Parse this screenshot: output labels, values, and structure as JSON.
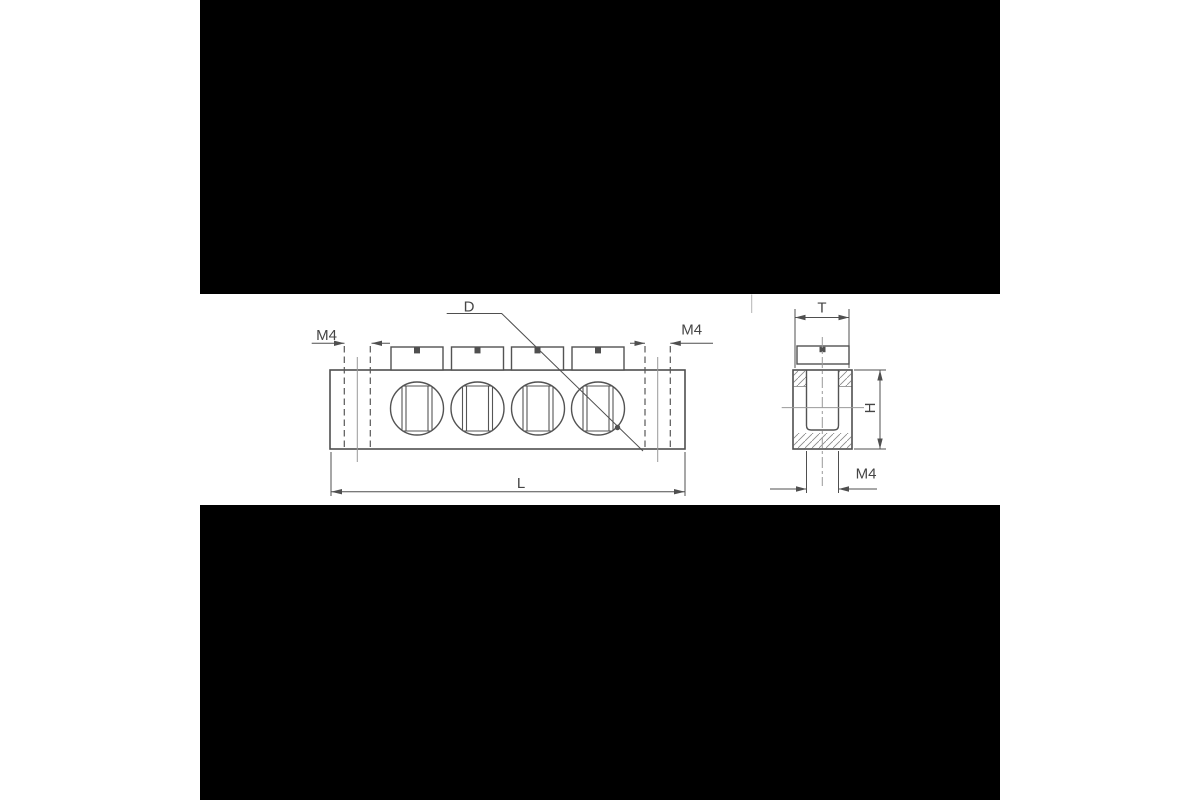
{
  "canvas": {
    "background": "#ffffff",
    "letterbox_color": "#000000"
  },
  "drawing": {
    "type": "technical-drawing",
    "subject": "terminal-block-two-views",
    "colors": {
      "line": "#4f4f4f",
      "centerline": "#9a9a9a",
      "hatch": "#878787",
      "text": "#454545"
    },
    "front": {
      "screw_count": "4",
      "m4_left": "M4",
      "m4_right": "M4",
      "hole_label": "D",
      "length_label": "L"
    },
    "side": {
      "width_label": "T",
      "height_label": "H",
      "thread_label": "M4"
    }
  }
}
